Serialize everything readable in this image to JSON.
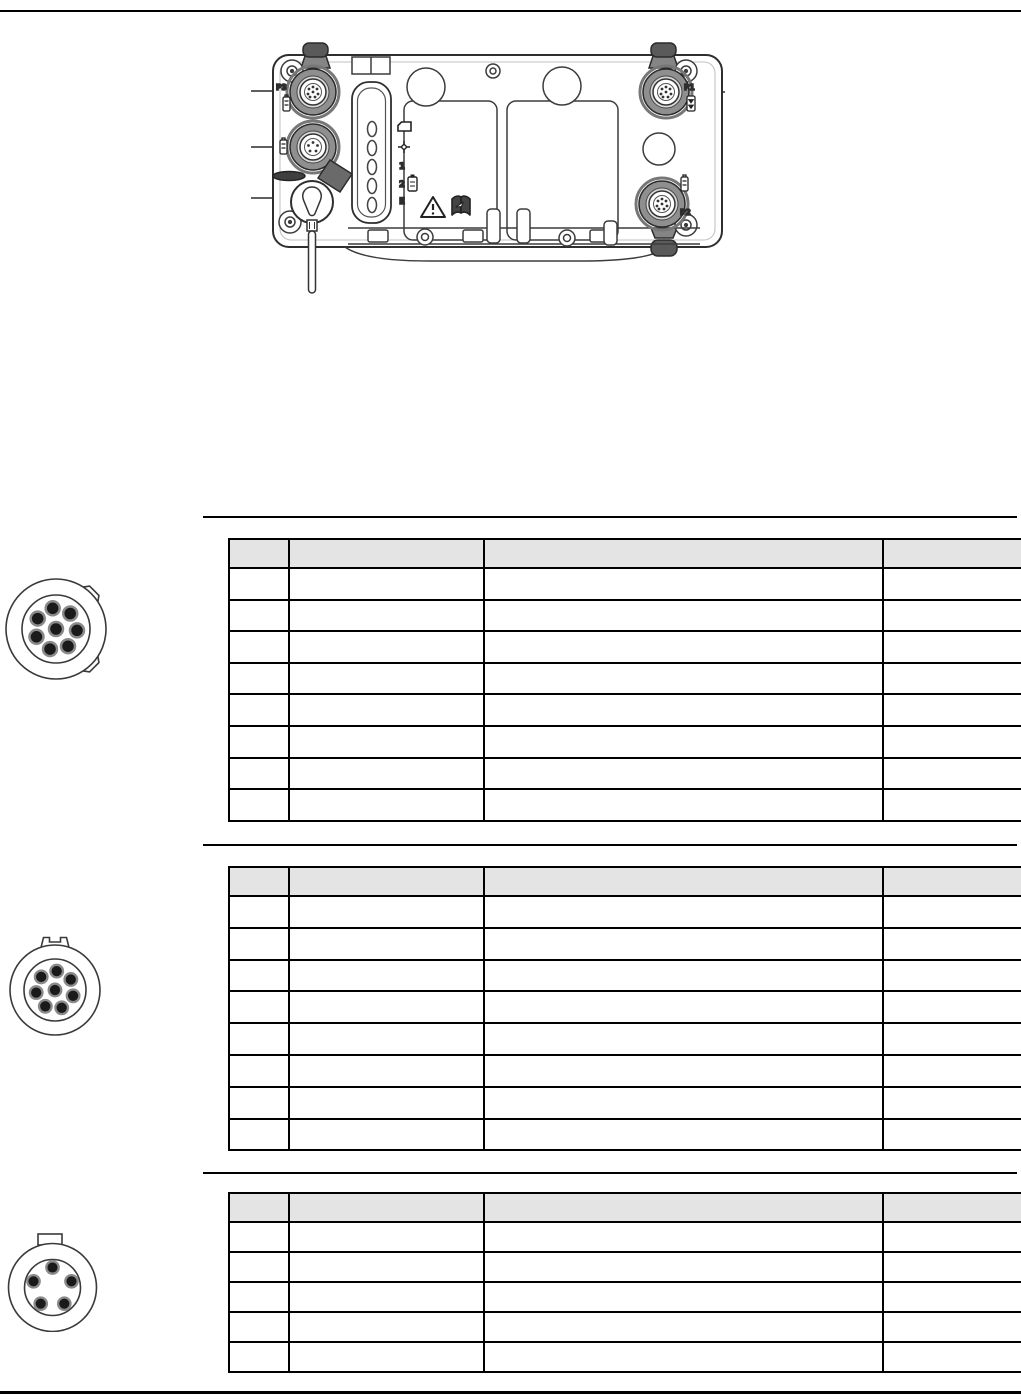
{
  "page": {
    "type": "technical-manual-page",
    "has_top_rule": true,
    "has_bottom_rule": true
  },
  "device": {
    "port_labels": {
      "p1": "P1",
      "p2": "P2",
      "p3": "P3"
    },
    "status_labels": {
      "led1": "1",
      "led2": "2",
      "led_e": "E"
    },
    "icons": [
      "memory-card-icon",
      "position-icon",
      "battery-icon",
      "warning-triangle-icon",
      "read-manual-icon",
      "port-type-icon",
      "pole-clamp",
      "protective-cap",
      "led-panel"
    ]
  },
  "connector_diagrams": [
    {
      "pins": 8,
      "layout": "1-center-7-ring",
      "keying": "two-right-side-keys"
    },
    {
      "pins": 8,
      "layout": "1-center-7-ring",
      "keying": "top-keyway-notch"
    },
    {
      "pins": 5,
      "layout": "pentagon",
      "keying": "top-tab"
    }
  ],
  "tables": [
    {
      "header": [
        "",
        "",
        "",
        ""
      ],
      "cols": 4,
      "rows": 8
    },
    {
      "header": [
        "",
        "",
        "",
        ""
      ],
      "cols": 4,
      "rows": 8
    },
    {
      "header": [
        "",
        "",
        "",
        ""
      ],
      "cols": 4,
      "rows": 5
    }
  ],
  "colors": {
    "table_header_fill": "#e4e4e4",
    "table_border": "#000000",
    "rule": "#000000",
    "clamp_dark": "#5a5a5a",
    "connector_ring": "#8f8f8f"
  }
}
